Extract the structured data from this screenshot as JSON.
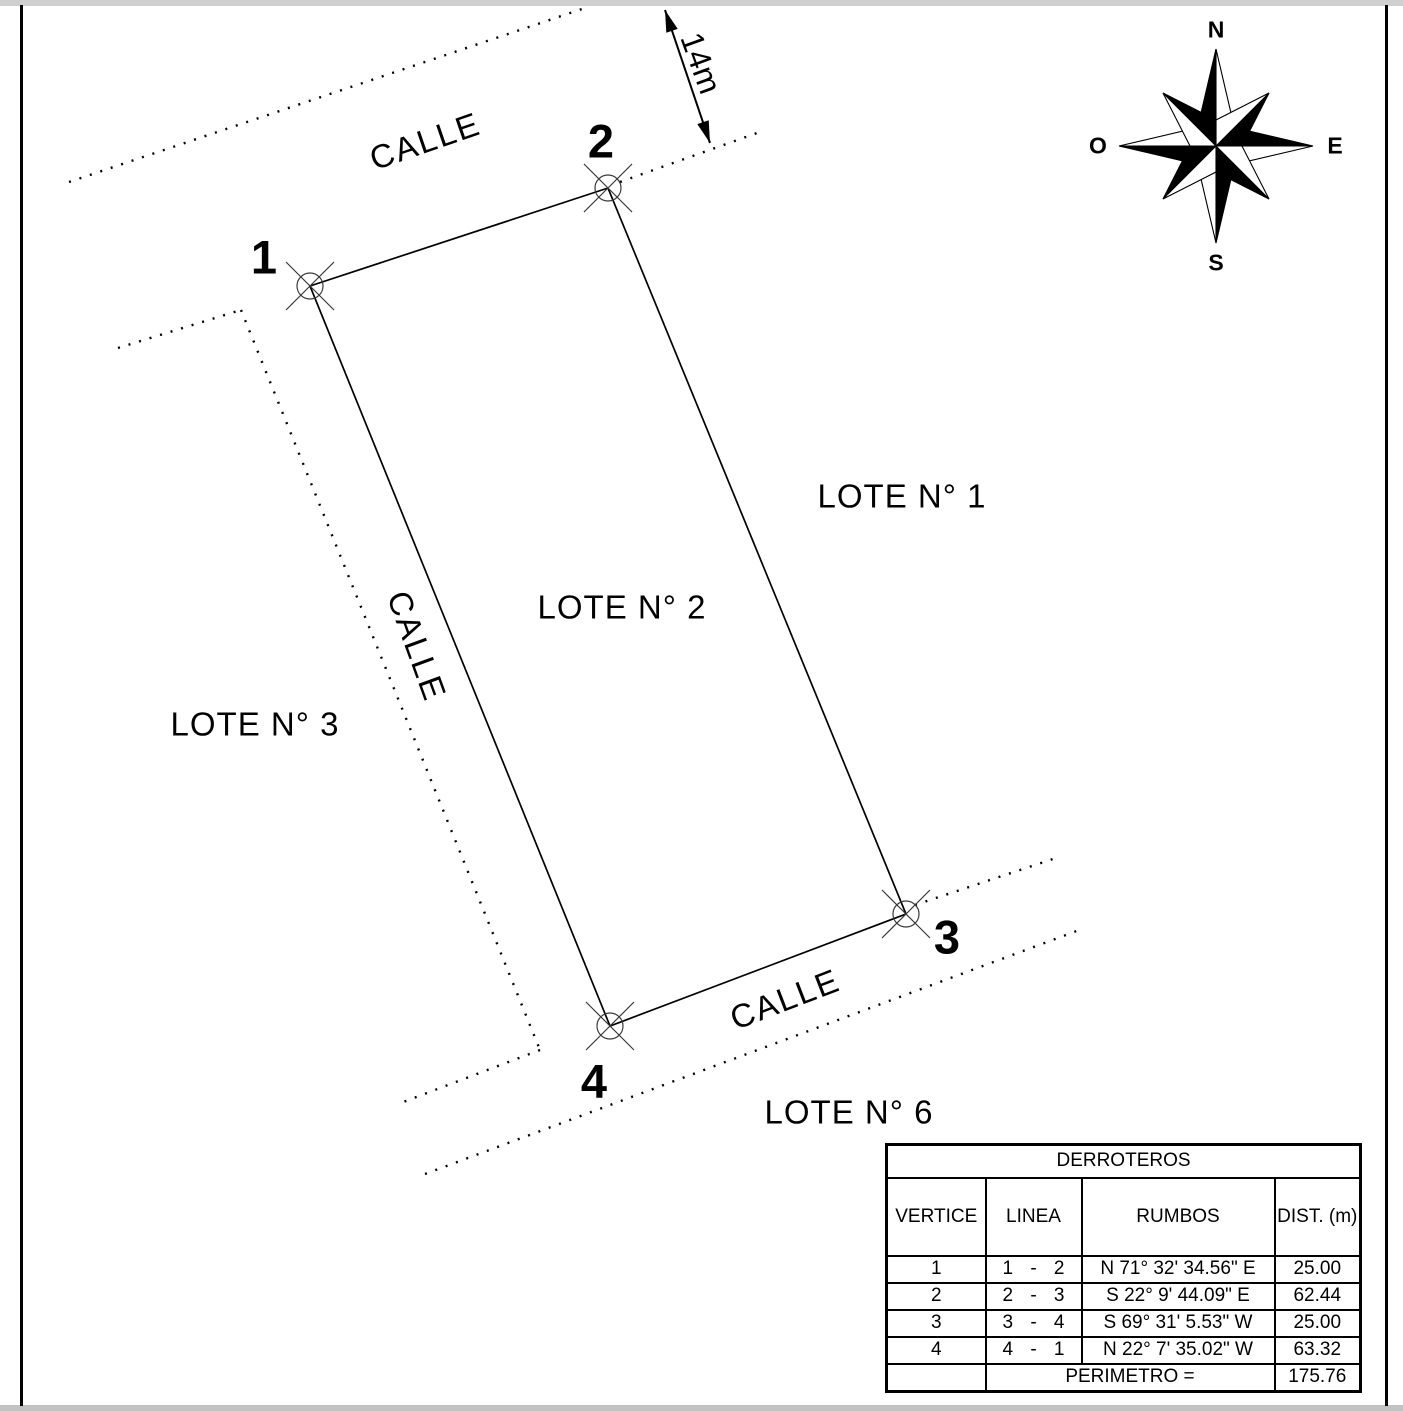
{
  "plan": {
    "streets": {
      "top": "CALLE",
      "left": "CALLE",
      "bottom": "CALLE"
    },
    "lots": {
      "lot1": "LOTE N° 1",
      "lot2": "LOTE N° 2",
      "lot3": "LOTE N° 3",
      "lot6": "LOTE N° 6"
    },
    "vertices": {
      "v1": "1",
      "v2": "2",
      "v3": "3",
      "v4": "4"
    },
    "dimension_label": "14m"
  },
  "compass": {
    "n": "N",
    "s": "S",
    "e": "E",
    "o": "O"
  },
  "table": {
    "title": "DERROTEROS",
    "headers": {
      "vertice": "VERTICE",
      "linea": "LINEA",
      "rumbos": "RUMBOS",
      "dist": "DIST. (m)"
    },
    "linea_sep": "-",
    "rows": [
      {
        "vertice": "1",
        "from": "1",
        "to": "2",
        "rumbo": "N 71° 32' 34.56\" E",
        "dist": "25.00"
      },
      {
        "vertice": "2",
        "from": "2",
        "to": "3",
        "rumbo": "S 22° 9' 44.09\" E",
        "dist": "62.44"
      },
      {
        "vertice": "3",
        "from": "3",
        "to": "4",
        "rumbo": "S 69° 31' 5.53\" W",
        "dist": "25.00"
      },
      {
        "vertice": "4",
        "from": "4",
        "to": "1",
        "rumbo": "N 22° 7' 35.02\" W",
        "dist": "63.32"
      }
    ],
    "footer": {
      "label": "PERIMETRO =",
      "value": "175.76"
    }
  }
}
